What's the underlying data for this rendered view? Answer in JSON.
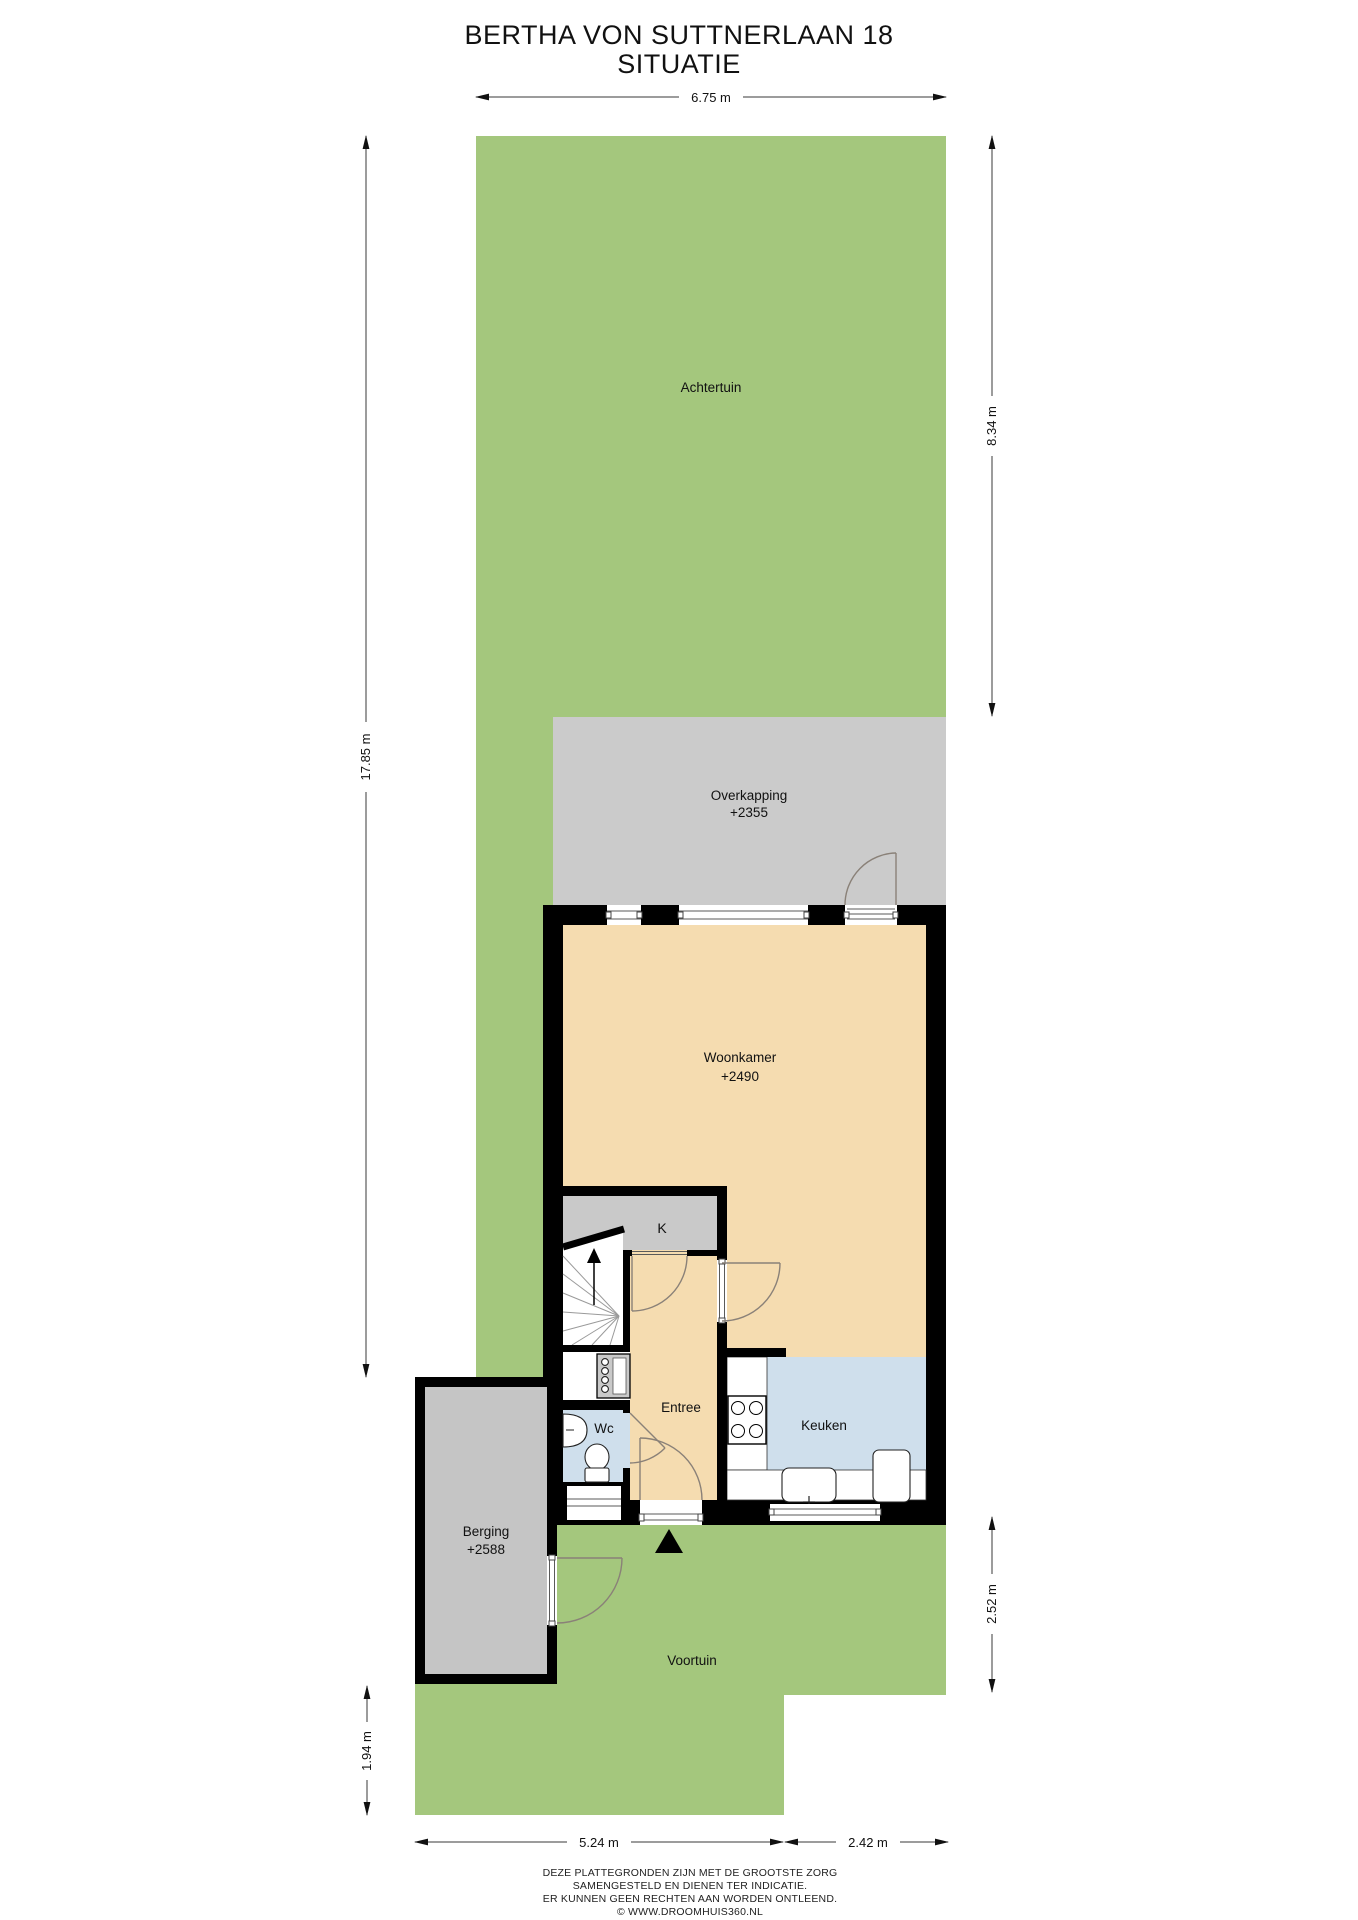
{
  "title": {
    "line1": "BERTHA VON SUTTNERLAAN 18",
    "line2": "SITUATIE"
  },
  "rooms": {
    "achtertuin": {
      "label": "Achtertuin"
    },
    "overkapping": {
      "label": "Overkapping",
      "level": "+2355"
    },
    "woonkamer": {
      "label": "Woonkamer",
      "level": "+2490"
    },
    "kast": {
      "label": "K"
    },
    "entree": {
      "label": "Entree"
    },
    "wc": {
      "label": "Wc"
    },
    "keuken": {
      "label": "Keuken"
    },
    "berging": {
      "label": "Berging",
      "level": "+2588"
    },
    "voortuin": {
      "label": "Voortuin"
    }
  },
  "dimensions": {
    "top_width": "6.75 m",
    "left_height": "17.85 m",
    "right_upper_height": "8.34 m",
    "right_lower_height": "2.52 m",
    "bottom_left_height": "1.94 m",
    "bottom_width_left": "5.24 m",
    "bottom_width_right": "2.42 m"
  },
  "disclaimer": {
    "line1": "DEZE PLATTEGRONDEN ZIJN MET DE GROOTSTE ZORG",
    "line2": "SAMENGESTELD EN DIENEN TER INDICATIE.",
    "line3": "ER KUNNEN GEEN RECHTEN AAN WORDEN ONTLEEND.",
    "line4": "© WWW.DROOMHUIS360.NL"
  },
  "icons": {
    "entrance_marker": "filled-triangle-up",
    "stairs_direction": "arrow-up",
    "dimension_arrowheads": "double-ended-arrow"
  },
  "colors": {
    "garden_green": "#a4c77d",
    "canopy_gray": "#cbcbcb",
    "wood_floor_beige": "#f5dcb0",
    "tile_floor_blue": "#cfdfec",
    "closet_gray": "#c9c9c9",
    "berging_gray": "#c5c5c5",
    "wall_black": "#000000",
    "background": "#ffffff"
  }
}
